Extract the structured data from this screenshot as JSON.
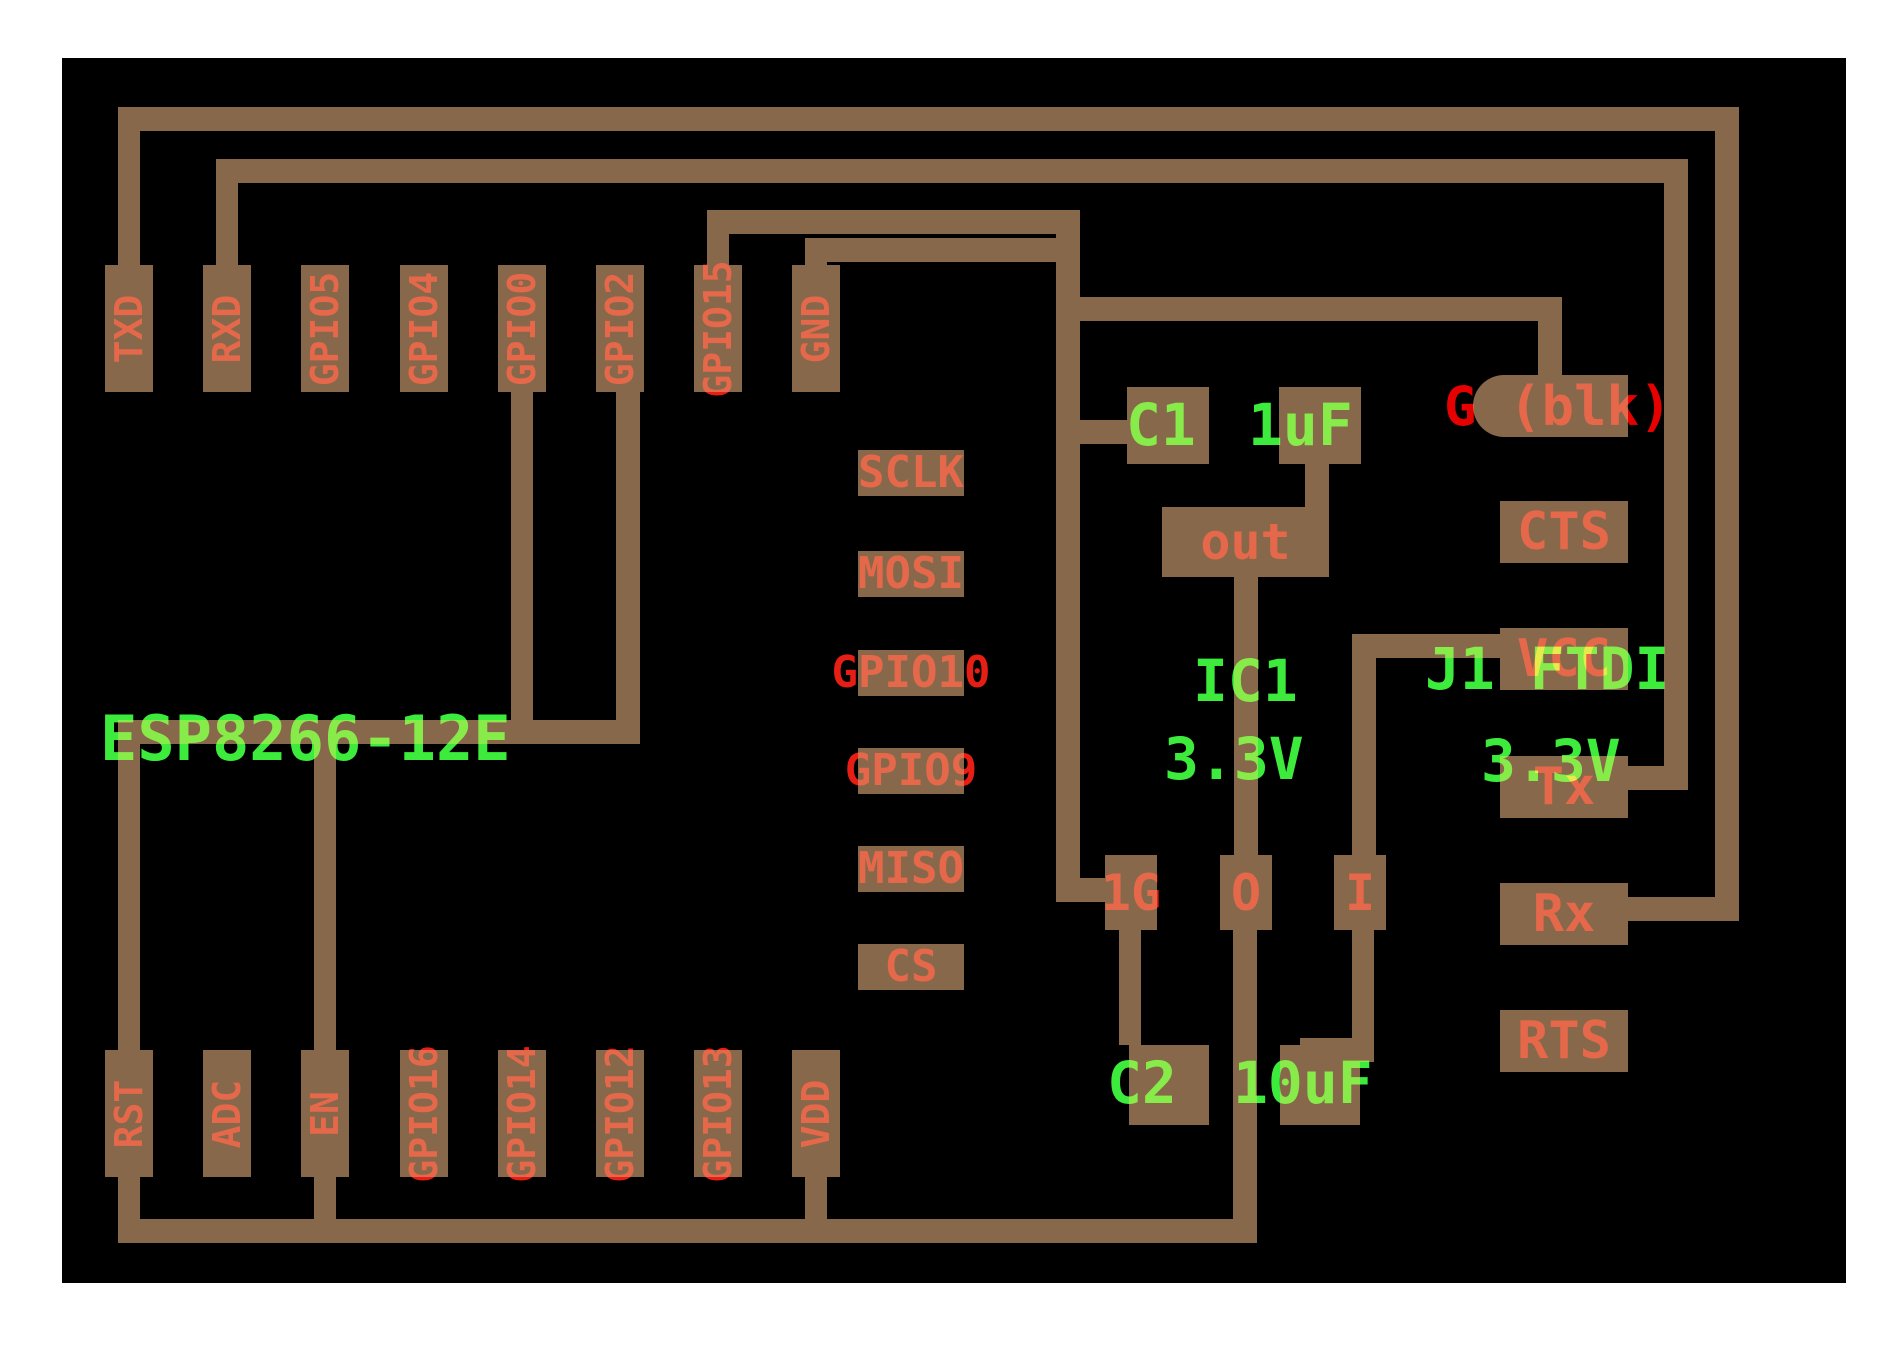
{
  "colors": {
    "background": "#ffffff",
    "board": "#000000",
    "copper": "#87684a",
    "pin_text_red": "#e61e14",
    "annotation_red": "#e60000",
    "silkscreen_green": "#3ceb3c"
  },
  "esp_module": {
    "label": "ESP8266-12E",
    "top_pins": [
      "TXD",
      "RXD",
      "GPIO5",
      "GPIO4",
      "GPIO0",
      "GPIO2",
      "GPIO15",
      "GND"
    ],
    "bottom_pins": [
      "RST",
      "ADC",
      "EN",
      "GPIO16",
      "GPIO14",
      "GPIO12",
      "GPIO13",
      "VDD"
    ],
    "inner_pins": [
      "SCLK",
      "MOSI",
      "GPIO10",
      "GPIO9",
      "MISO",
      "CS"
    ]
  },
  "regulator": {
    "ref": "IC1",
    "value": "3.3V",
    "output_pad_label": "out",
    "pins": [
      "1G",
      "O",
      "I"
    ]
  },
  "capacitor1": {
    "ref": "C1",
    "value": "1uF"
  },
  "capacitor2": {
    "ref": "C2",
    "value": "10uF"
  },
  "ftdi_header": {
    "ref_label": "J1 FTDI",
    "value": "3.3V",
    "ground_pad_label": "G (blk)",
    "pins": [
      "CTS",
      "VCC",
      "Tx",
      "Rx",
      "RTS"
    ]
  }
}
